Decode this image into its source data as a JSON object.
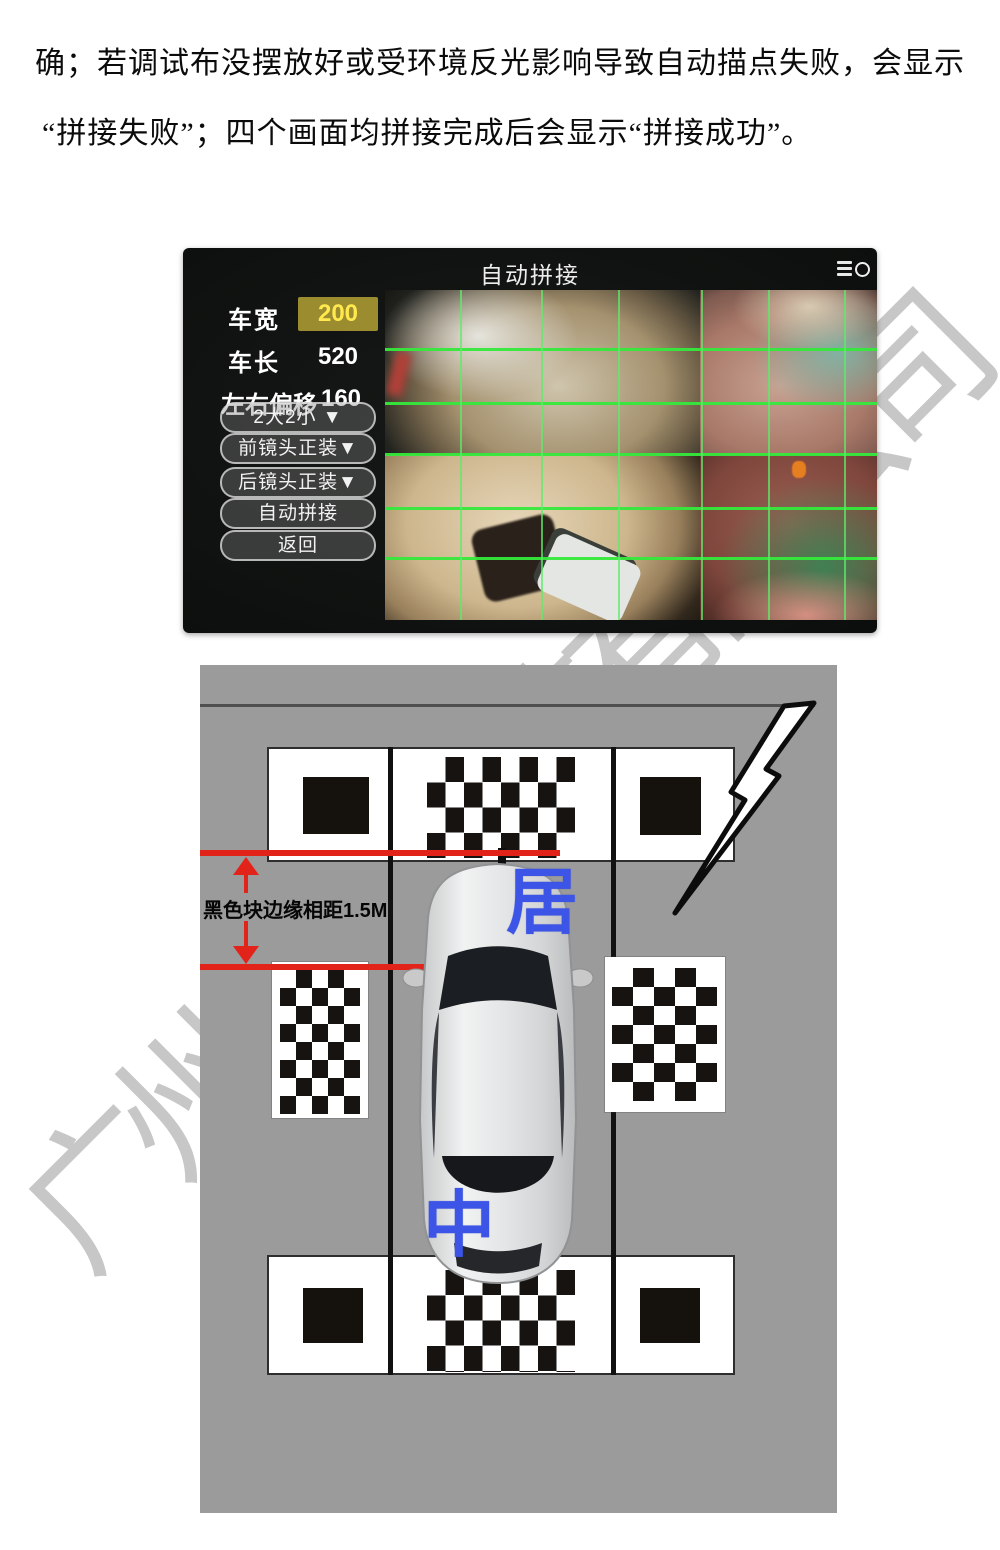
{
  "document": {
    "paragraph": {
      "line1": "确；若调试布没摆放好或受环境反光影响导致自动描点失败，会显示",
      "line2": "“拼接失败”；四个画面均拼接完成后会显示“拼接成功”。"
    },
    "watermark_text": "广州电子科技有限公司"
  },
  "ui_screen": {
    "title": "自动拼接",
    "fields": [
      {
        "label": "车宽",
        "value": "200"
      },
      {
        "label": "车长",
        "value": "520"
      },
      {
        "label": "左右偏移",
        "value": "160"
      }
    ],
    "buttons": [
      {
        "label": "2大2小  ▼"
      },
      {
        "label": "前镜头正装▼"
      },
      {
        "label": "后镜头正装▼"
      },
      {
        "label": "自动拼接"
      },
      {
        "label": "返回"
      }
    ],
    "colors": {
      "grid_green": "#35e93b",
      "value_highlight_bg": "#9a8c2f",
      "value_highlight_text": "#ffe94f"
    }
  },
  "diagram": {
    "distance_label": "黑色块边缘相距1.5M",
    "marker_top": "居",
    "marker_bottom": "中",
    "colors": {
      "marker_blue": "#3d55e6",
      "annotation_red": "#e2231a",
      "background_gray": "#9b9b9b"
    }
  }
}
